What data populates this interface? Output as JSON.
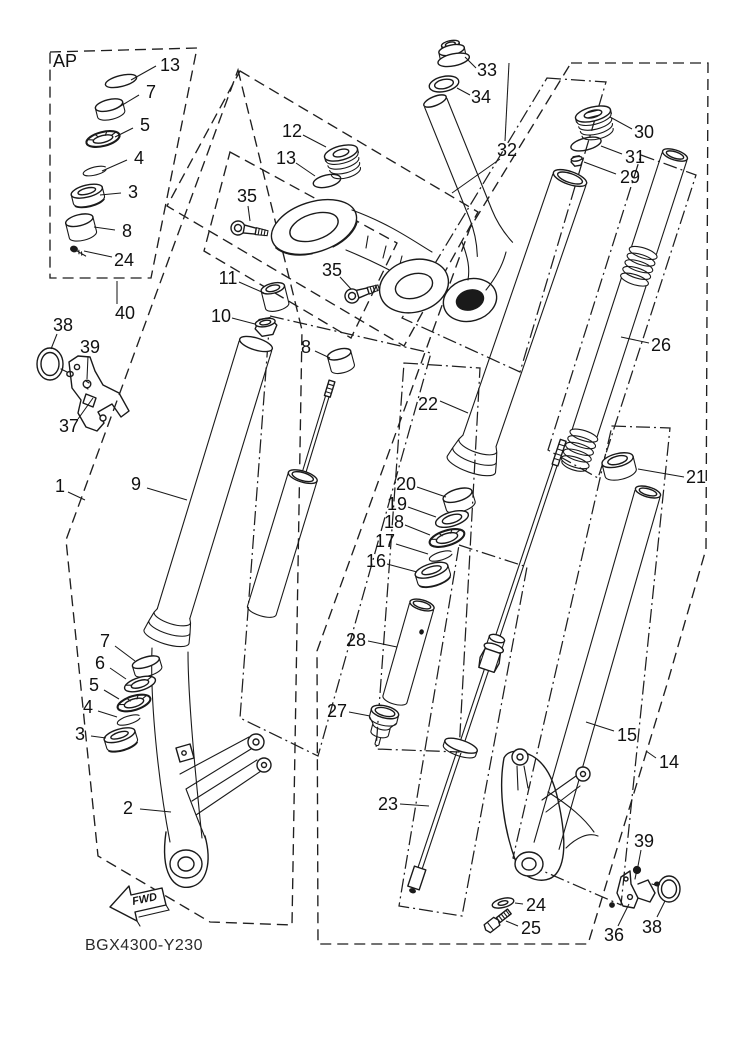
{
  "diagram": {
    "code": "BGX4300-Y230",
    "fwd_label": "FWD",
    "ap_label": "AP",
    "line_color": "#1a1a1a",
    "background": "#ffffff"
  },
  "callouts": [
    {
      "part": "13",
      "x": 170,
      "y": 65,
      "leaders": [
        [
          [
            156,
            66
          ],
          [
            131,
            80
          ]
        ]
      ]
    },
    {
      "part": "7",
      "x": 151,
      "y": 92,
      "leaders": [
        [
          [
            139,
            95
          ],
          [
            119,
            107
          ]
        ]
      ]
    },
    {
      "part": "5",
      "x": 145,
      "y": 125,
      "leaders": [
        [
          [
            133,
            128
          ],
          [
            115,
            137
          ]
        ]
      ]
    },
    {
      "part": "4",
      "x": 139,
      "y": 158,
      "leaders": [
        [
          [
            127,
            160
          ],
          [
            102,
            171
          ]
        ]
      ]
    },
    {
      "part": "3",
      "x": 133,
      "y": 192,
      "leaders": [
        [
          [
            121,
            193
          ],
          [
            100,
            195
          ]
        ]
      ]
    },
    {
      "part": "8",
      "x": 127,
      "y": 231,
      "leaders": [
        [
          [
            115,
            230
          ],
          [
            94,
            227
          ]
        ]
      ]
    },
    {
      "part": "24",
      "x": 124,
      "y": 260,
      "leaders": [
        [
          [
            112,
            257
          ],
          [
            84,
            251
          ]
        ]
      ]
    },
    {
      "part": "40",
      "x": 125,
      "y": 313,
      "leaders": [
        [
          [
            117,
            304
          ],
          [
            117,
            281
          ]
        ]
      ]
    },
    {
      "part": "38",
      "x": 63,
      "y": 325,
      "leaders": [
        [
          [
            57,
            334
          ],
          [
            51,
            349
          ]
        ]
      ]
    },
    {
      "part": "39",
      "x": 90,
      "y": 347,
      "leaders": [
        [
          [
            88,
            356
          ],
          [
            87,
            379
          ]
        ]
      ]
    },
    {
      "part": "37",
      "x": 69,
      "y": 426,
      "leaders": [
        [
          [
            78,
            419
          ],
          [
            93,
            398
          ]
        ]
      ]
    },
    {
      "part": "1",
      "x": 60,
      "y": 486,
      "leaders": [
        [
          [
            68,
            492
          ],
          [
            85,
            500
          ]
        ]
      ]
    },
    {
      "part": "9",
      "x": 136,
      "y": 484,
      "leaders": [
        [
          [
            147,
            488
          ],
          [
            187,
            500
          ]
        ]
      ]
    },
    {
      "part": "2",
      "x": 128,
      "y": 808,
      "leaders": [
        [
          [
            140,
            809
          ],
          [
            171,
            812
          ]
        ]
      ]
    },
    {
      "part": "7",
      "x": 105,
      "y": 641,
      "leaders": [
        [
          [
            115,
            646
          ],
          [
            135,
            661
          ]
        ]
      ]
    },
    {
      "part": "6",
      "x": 100,
      "y": 663,
      "leaders": [
        [
          [
            110,
            668
          ],
          [
            126,
            679
          ]
        ]
      ]
    },
    {
      "part": "5",
      "x": 94,
      "y": 685,
      "leaders": [
        [
          [
            104,
            690
          ],
          [
            119,
            699
          ]
        ]
      ]
    },
    {
      "part": "4",
      "x": 88,
      "y": 707,
      "leaders": [
        [
          [
            98,
            711
          ],
          [
            117,
            717
          ]
        ]
      ]
    },
    {
      "part": "3",
      "x": 80,
      "y": 734,
      "leaders": [
        [
          [
            91,
            736
          ],
          [
            106,
            738
          ]
        ]
      ]
    },
    {
      "part": "12",
      "x": 292,
      "y": 131,
      "leaders": [
        [
          [
            303,
            135
          ],
          [
            326,
            147
          ]
        ]
      ]
    },
    {
      "part": "13",
      "x": 286,
      "y": 158,
      "leaders": [
        [
          [
            296,
            163
          ],
          [
            315,
            176
          ]
        ]
      ]
    },
    {
      "part": "35",
      "x": 247,
      "y": 196,
      "leaders": [
        [
          [
            248,
            206
          ],
          [
            250,
            221
          ]
        ]
      ]
    },
    {
      "part": "35",
      "x": 332,
      "y": 270,
      "leaders": [
        [
          [
            340,
            277
          ],
          [
            351,
            289
          ]
        ]
      ]
    },
    {
      "part": "11",
      "x": 228,
      "y": 278,
      "leaders": [
        [
          [
            239,
            282
          ],
          [
            264,
            293
          ]
        ]
      ]
    },
    {
      "part": "10",
      "x": 221,
      "y": 316,
      "leaders": [
        [
          [
            232,
            318
          ],
          [
            255,
            324
          ]
        ]
      ]
    },
    {
      "part": "8",
      "x": 306,
      "y": 347,
      "leaders": [
        [
          [
            315,
            351
          ],
          [
            330,
            358
          ]
        ]
      ]
    },
    {
      "part": "33",
      "x": 487,
      "y": 70,
      "leaders": [
        [
          [
            476,
            68
          ],
          [
            465,
            57
          ]
        ]
      ]
    },
    {
      "part": "34",
      "x": 481,
      "y": 97,
      "leaders": [
        [
          [
            470,
            95
          ],
          [
            457,
            88
          ]
        ]
      ]
    },
    {
      "part": "32",
      "x": 507,
      "y": 150,
      "leaders": [
        [
          [
            505,
            141
          ],
          [
            509,
            63
          ]
        ],
        [
          [
            500,
            159
          ],
          [
            452,
            193
          ]
        ]
      ]
    },
    {
      "part": "30",
      "x": 644,
      "y": 132,
      "leaders": [
        [
          [
            632,
            129
          ],
          [
            610,
            117
          ]
        ]
      ]
    },
    {
      "part": "31",
      "x": 635,
      "y": 157,
      "leaders": [
        [
          [
            622,
            154
          ],
          [
            601,
            146
          ]
        ]
      ]
    },
    {
      "part": "29",
      "x": 630,
      "y": 177,
      "leaders": [
        [
          [
            616,
            174
          ],
          [
            584,
            162
          ]
        ]
      ]
    },
    {
      "part": "26",
      "x": 661,
      "y": 345,
      "leaders": [
        [
          [
            649,
            343
          ],
          [
            621,
            337
          ]
        ]
      ]
    },
    {
      "part": "21",
      "x": 696,
      "y": 477,
      "leaders": [
        [
          [
            684,
            477
          ],
          [
            638,
            469
          ]
        ]
      ]
    },
    {
      "part": "22",
      "x": 428,
      "y": 404,
      "leaders": [
        [
          [
            440,
            401
          ],
          [
            468,
            413
          ]
        ]
      ]
    },
    {
      "part": "20",
      "x": 406,
      "y": 484,
      "leaders": [
        [
          [
            417,
            487
          ],
          [
            446,
            497
          ]
        ]
      ]
    },
    {
      "part": "19",
      "x": 397,
      "y": 504,
      "leaders": [
        [
          [
            408,
            507
          ],
          [
            436,
            517
          ]
        ]
      ]
    },
    {
      "part": "18",
      "x": 394,
      "y": 522,
      "leaders": [
        [
          [
            405,
            525
          ],
          [
            430,
            535
          ]
        ]
      ]
    },
    {
      "part": "17",
      "x": 385,
      "y": 541,
      "leaders": [
        [
          [
            396,
            544
          ],
          [
            428,
            554
          ]
        ]
      ]
    },
    {
      "part": "16",
      "x": 376,
      "y": 561,
      "leaders": [
        [
          [
            387,
            564
          ],
          [
            417,
            572
          ]
        ]
      ]
    },
    {
      "part": "28",
      "x": 356,
      "y": 640,
      "leaders": [
        [
          [
            368,
            641
          ],
          [
            397,
            647
          ]
        ]
      ]
    },
    {
      "part": "27",
      "x": 337,
      "y": 711,
      "leaders": [
        [
          [
            349,
            712
          ],
          [
            370,
            716
          ]
        ]
      ]
    },
    {
      "part": "23",
      "x": 388,
      "y": 804,
      "leaders": [
        [
          [
            400,
            804
          ],
          [
            429,
            806
          ]
        ]
      ]
    },
    {
      "part": "15",
      "x": 627,
      "y": 735,
      "leaders": [
        [
          [
            614,
            731
          ],
          [
            586,
            722
          ]
        ]
      ]
    },
    {
      "part": "14",
      "x": 669,
      "y": 762,
      "leaders": [
        [
          [
            656,
            758
          ],
          [
            646,
            751
          ]
        ]
      ]
    },
    {
      "part": "24",
      "x": 536,
      "y": 905,
      "leaders": [
        [
          [
            523,
            904
          ],
          [
            515,
            903
          ]
        ]
      ]
    },
    {
      "part": "25",
      "x": 531,
      "y": 928,
      "leaders": [
        [
          [
            518,
            926
          ],
          [
            506,
            921
          ]
        ]
      ]
    },
    {
      "part": "39",
      "x": 644,
      "y": 841,
      "leaders": [
        [
          [
            641,
            850
          ],
          [
            638,
            866
          ]
        ]
      ]
    },
    {
      "part": "36",
      "x": 614,
      "y": 935,
      "leaders": [
        [
          [
            618,
            926
          ],
          [
            629,
            904
          ]
        ]
      ]
    },
    {
      "part": "38",
      "x": 652,
      "y": 927,
      "leaders": [
        [
          [
            657,
            917
          ],
          [
            665,
            901
          ]
        ]
      ]
    }
  ]
}
